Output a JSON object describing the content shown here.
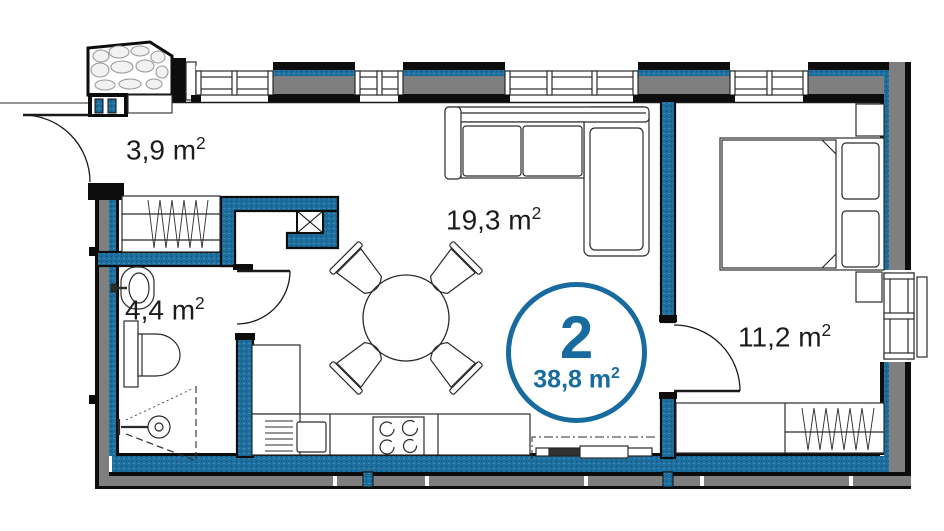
{
  "title": "Apartment floor plan, unit 2",
  "badge": {
    "number": "2",
    "area_value": "38,8 m",
    "area_sup": "2"
  },
  "rooms": [
    {
      "name": "hallway",
      "area_value": "3,9 m",
      "area_sup": "2"
    },
    {
      "name": "living-kitchen",
      "area_value": "19,3 m",
      "area_sup": "2"
    },
    {
      "name": "bathroom",
      "area_value": "4,4 m",
      "area_sup": "2"
    },
    {
      "name": "bedroom",
      "area_value": "11,2 m",
      "area_sup": "2"
    }
  ],
  "colors": {
    "accent_blue": "#176b9e",
    "wall_core_blue": "#1d6f9f",
    "wall_gray": "#7f7f7f",
    "wall_black": "#0d0d0d",
    "line_dark": "#2b2b2b",
    "stone_gray": "#9b9b9b"
  }
}
